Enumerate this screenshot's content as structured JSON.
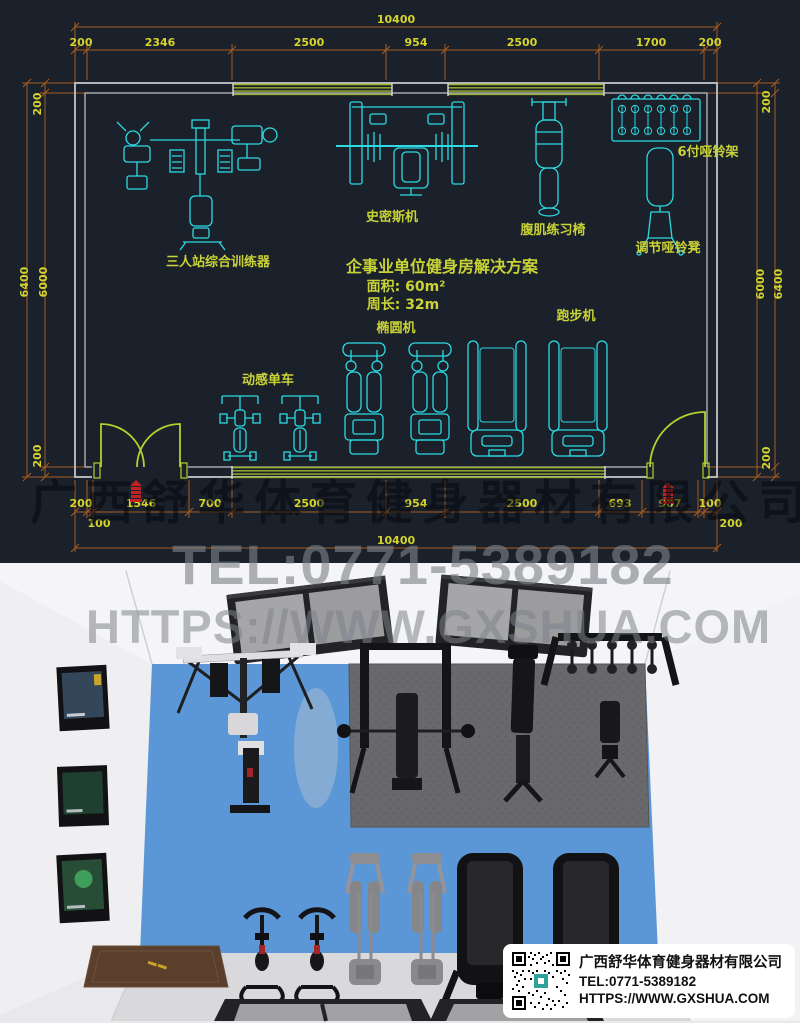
{
  "cad": {
    "dims": {
      "top_total": "10400",
      "top_segments": [
        "200",
        "2346",
        "2500",
        "954",
        "2500",
        "1700",
        "200"
      ],
      "bottom_row1": [
        "200",
        "1546",
        "700",
        "2500",
        "954",
        "2500",
        "693",
        "907",
        "100"
      ],
      "bottom_row2": [
        "100",
        "200"
      ],
      "bottom_total": "10400",
      "left": {
        "wall_top": "200",
        "outer": "6400",
        "inner": "6000",
        "wall_bottom": "200"
      },
      "right": {
        "wall_top": "200",
        "inner": "6000",
        "outer": "6400",
        "wall_bottom": "200"
      }
    },
    "labels": {
      "multi_station": "三人站综合训练器",
      "smith_machine": "史密斯机",
      "ab_bench": "腹肌练习椅",
      "dumbbell_rack": "6付哑铃架",
      "adjustable_bench": "调节哑铃凳",
      "spin_bike": "动感单车",
      "elliptical": "椭圆机",
      "treadmill": "跑步机"
    },
    "solution": {
      "title": "企事业单位健身房解决方案",
      "area": "面积: 60m²",
      "perimeter": "周长: 32m"
    },
    "colors": {
      "background": "#1a212b",
      "equipment": "#2ed9e1",
      "dimension_text": "#d6d42c",
      "dimension_line": "#a85c20",
      "label_text": "#c9d236",
      "window": "#9db32b",
      "wall": "#d8d8d8",
      "door": "#b5cf2d",
      "seal_red": "#c32222"
    }
  },
  "render": {
    "floor_color": "#5b97d6",
    "mat_color": "#69696c"
  },
  "watermarks": {
    "company": "广西舒华体育健身器材有限公司",
    "tel": "TEL:0771-5389182",
    "url": "HTTPS://WWW.GXSHUA.COM"
  },
  "info_card": {
    "company": "广西舒华体育健身器材有限公司",
    "tel": "TEL:0771-5389182",
    "url": "HTTPS://WWW.GXSHUA.COM"
  }
}
